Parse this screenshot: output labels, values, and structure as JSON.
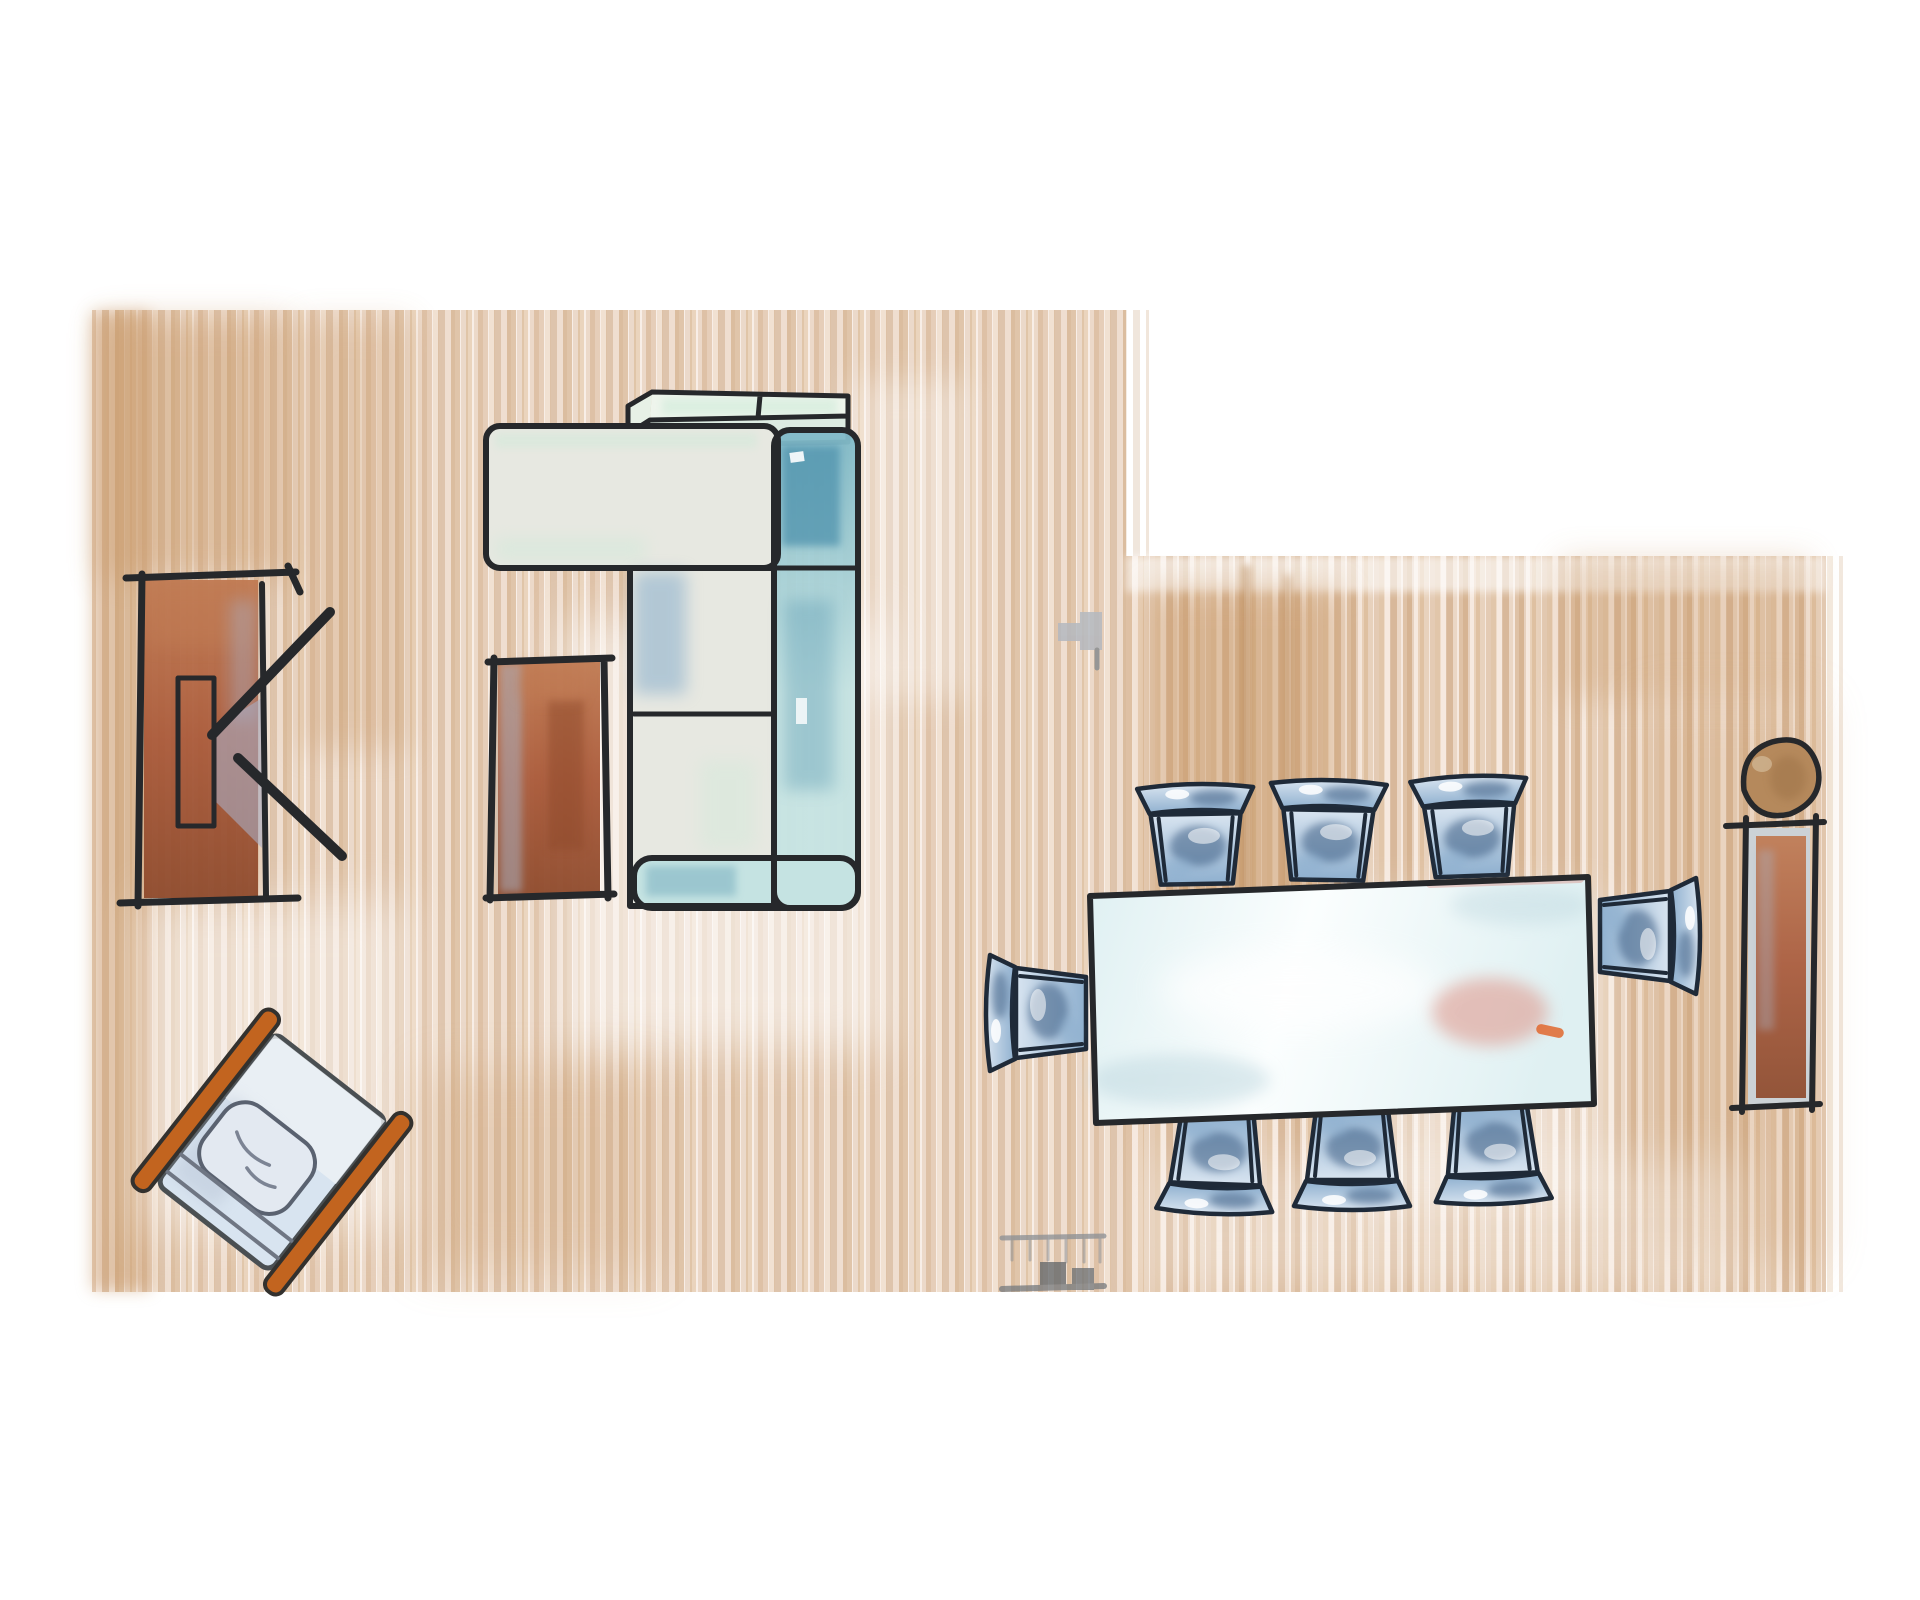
{
  "scene": {
    "kind": "watercolor floor plan illustration, top-down furniture layout",
    "text_content": "none (image contains no rendered text)",
    "rooms": [
      {
        "id": "living-room",
        "floor": "tan vertical wood-plank watercolor wash on white paper"
      },
      {
        "id": "dining-room",
        "floor": "tan vertical wood-plank watercolor wash, slightly deeper tone"
      }
    ]
  },
  "furniture": [
    {
      "id": "sideboard-sketch",
      "room": "living-room",
      "kind": "rust console/rug with black K-shaped pen sketch",
      "colors": [
        "sienna",
        "ink",
        "greyWash"
      ]
    },
    {
      "id": "sofa-console",
      "room": "living-room",
      "kind": "narrow console behind sofa",
      "colors": [
        "mintPale"
      ]
    },
    {
      "id": "sectional-sofa",
      "room": "living-room",
      "kind": "L-shaped sectional sofa with chaise",
      "colors": [
        "cushion",
        "teal",
        "tealPale",
        "blueWash"
      ]
    },
    {
      "id": "coffee-table",
      "room": "living-room",
      "kind": "rectangular rust coffee table",
      "colors": [
        "sienna"
      ]
    },
    {
      "id": "armchair",
      "room": "living-room",
      "kind": "rotated armchair with orange wood rails and pillow",
      "colors": [
        "orangeWood",
        "chairLight"
      ]
    },
    {
      "id": "dining-table",
      "room": "dining-room",
      "kind": "rectangular dining table, white with blue wash and pink smudge",
      "colors": [
        "tableWash",
        "pinkSmudge",
        "redDash"
      ]
    },
    {
      "id": "dining-chair",
      "room": "dining-room",
      "kind": "flared blue watercolor chair",
      "count": 8,
      "layout": "3 top, 3 bottom, 1 left end, 1 right end",
      "colors": [
        "chairLight",
        "chairMid",
        "chairDark"
      ]
    },
    {
      "id": "side-cabinet",
      "room": "dining-room",
      "kind": "narrow rust sideboard on right wall",
      "colors": [
        "sienna"
      ]
    },
    {
      "id": "round-stool",
      "room": "dining-room",
      "kind": "round brown stool / planter",
      "colors": [
        "woodBrown"
      ]
    },
    {
      "id": "wall-fixture-sketch",
      "room": "dining-room",
      "kind": "small grey fixture sketch on dividing wall",
      "colors": [
        "greySoft"
      ]
    },
    {
      "id": "radiator-sketch",
      "room": "dining-room",
      "kind": "faint grey radiator/vent pen marks at bottom wall",
      "colors": [
        "greyLine"
      ]
    }
  ],
  "palette": {
    "paper": "#ffffff",
    "ink": "#26282b",
    "floorBase": "#f8eee7",
    "floorBaseDining": "#f6e9df",
    "stripe": "#c89b6e",
    "stripeLight": "#dcba94",
    "stripeDark": "#b98a5a",
    "stain": "#c99a6a",
    "sienna": "#aa5a3a",
    "siennaDeep": "#8e4a2c",
    "siennaLight": "#c07a52",
    "mint": "#cdead8",
    "mintPale": "#eef5ec",
    "cushion": "#e7e8e1",
    "teal": "#7fb9c8",
    "tealDeep": "#4f93ad",
    "tealPale": "#c5e3e2",
    "blueWash": "#7ea7c9",
    "chairLight": "#d8e4f0",
    "chairMid": "#8fb0cf",
    "chairDark": "#33527a",
    "navyInk": "#1f2a38",
    "orangeWood": "#c2641f",
    "tableWash": "#dff0f2",
    "pinkSmudge": "#df9b90",
    "redDash": "#e0672e",
    "woodBrown": "#b5895c",
    "greyWash": "#a9aec4",
    "greyLine": "#8a8f94",
    "greySoft": "#b4b8bf",
    "lavender": "#aab0c0"
  },
  "canvas": {
    "width": 1920,
    "height": 1600,
    "background": "#ffffff"
  }
}
